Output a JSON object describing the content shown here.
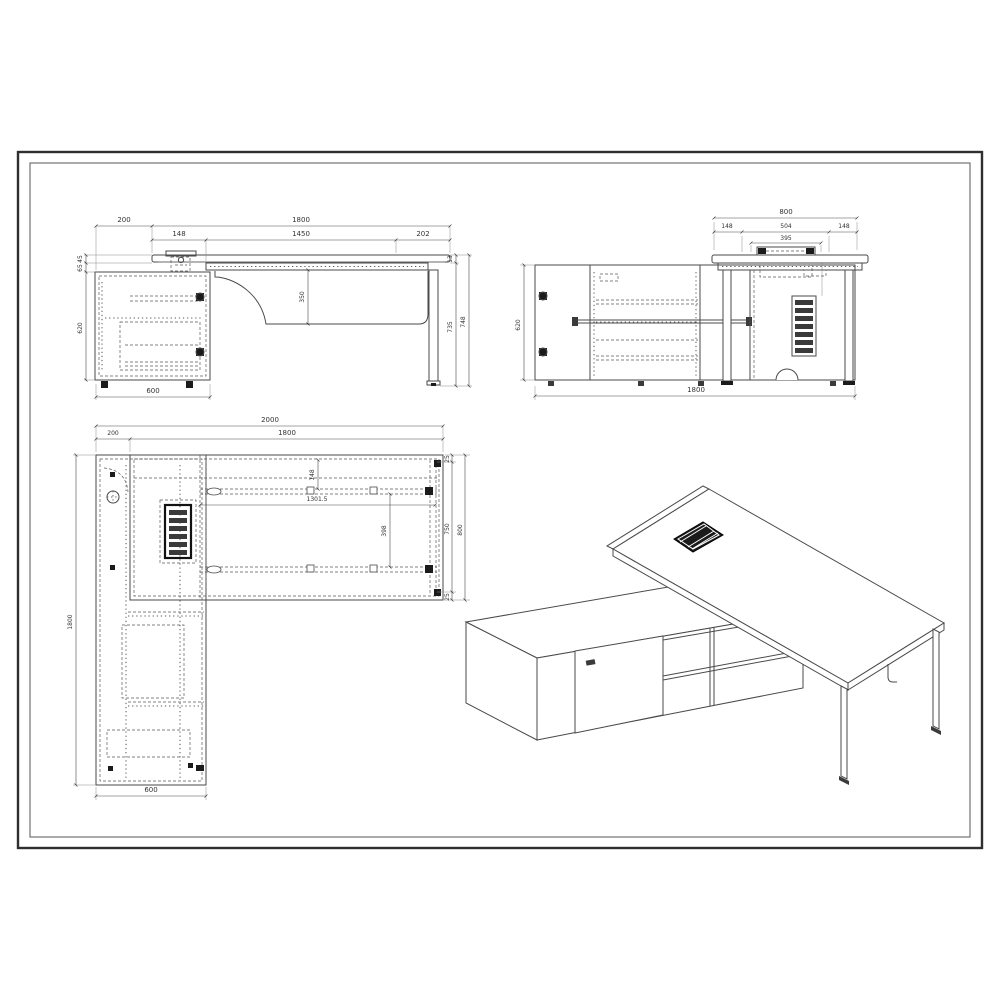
{
  "sheet": {
    "background": "#ffffff",
    "frame_color": "#2f2f2f",
    "line_color": "#4a4a4a",
    "dim_color": "#333333",
    "fill_black": "#1b1b1b"
  },
  "views": {
    "front_elevation": {
      "dims": {
        "offset_left": "200",
        "overall_width": "1800",
        "top_inset_left": "148",
        "top_clear_span": "1450",
        "top_inset_right": "202",
        "modesty_height": "350",
        "top_thickness": "13",
        "underside_height": "735",
        "overall_height": "748",
        "gap_top": "45",
        "gap_lower": "65",
        "cabinet_height": "620",
        "cabinet_depth": "600"
      }
    },
    "side_elevation": {
      "dims": {
        "desk_depth": "800",
        "overhang_left": "148",
        "box_frame": "504",
        "overhang_right": "148",
        "box_cutout": "395",
        "credenza_height": "620",
        "credenza_length": "1800"
      }
    },
    "plan": {
      "dims": {
        "overall_length": "2000",
        "offset_left": "200",
        "desk_length": "1800",
        "rail_setback": "148",
        "rail_length": "1301.5",
        "rail_spacing": "398",
        "edge_top": "25",
        "inner_depth": "750",
        "desk_depth": "800",
        "edge_bottom": "25",
        "credenza_length": "1800",
        "credenza_depth": "600"
      }
    }
  }
}
